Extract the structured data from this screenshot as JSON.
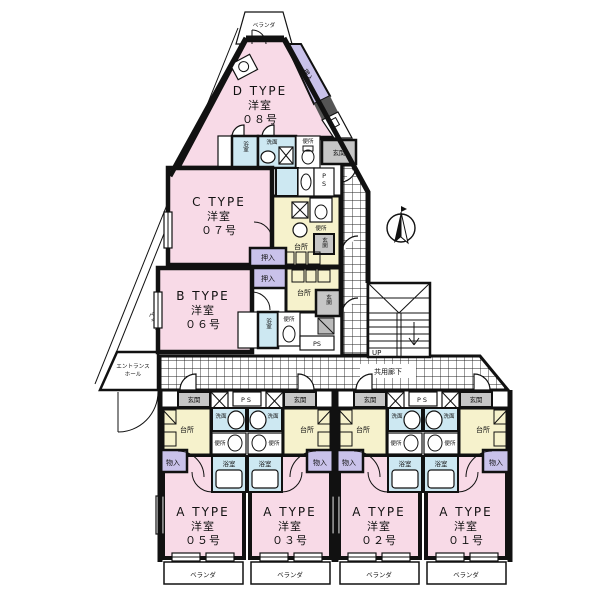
{
  "units": [
    {
      "id": "d08",
      "type": "D TYPE",
      "room": "洋室",
      "number": "０８号"
    },
    {
      "id": "c07",
      "type": "C TYPE",
      "room": "洋室",
      "number": "０７号"
    },
    {
      "id": "b06",
      "type": "B TYPE",
      "room": "洋室",
      "number": "０６号"
    },
    {
      "id": "a05",
      "type": "A TYPE",
      "room": "洋室",
      "number": "０５号"
    },
    {
      "id": "a03",
      "type": "A TYPE",
      "room": "洋室",
      "number": "０３号"
    },
    {
      "id": "a02",
      "type": "A TYPE",
      "room": "洋室",
      "number": "０２号"
    },
    {
      "id": "a01",
      "type": "A TYPE",
      "room": "洋室",
      "number": "０１号"
    }
  ],
  "rooms": {
    "bath": "浴室",
    "wash": "洗面",
    "toilet": "便所",
    "entrance": "玄関",
    "kitchen": "台所",
    "closet": "押入",
    "storage": "物入",
    "pipe_space": "PS"
  },
  "common": {
    "veranda": "ベランダ",
    "corridor": "共用廊下",
    "hall_line1": "エントランス",
    "hall_line2": "ホール",
    "up": "UP"
  },
  "colors": {
    "room_pink": "#F8DAE7",
    "kitchen_yellow": "#F6F2CC",
    "bath_blue": "#CDE8F2",
    "closet_purple": "#C9C2EA",
    "entrance_gray": "#C6C6C6",
    "wall": "#111111"
  }
}
